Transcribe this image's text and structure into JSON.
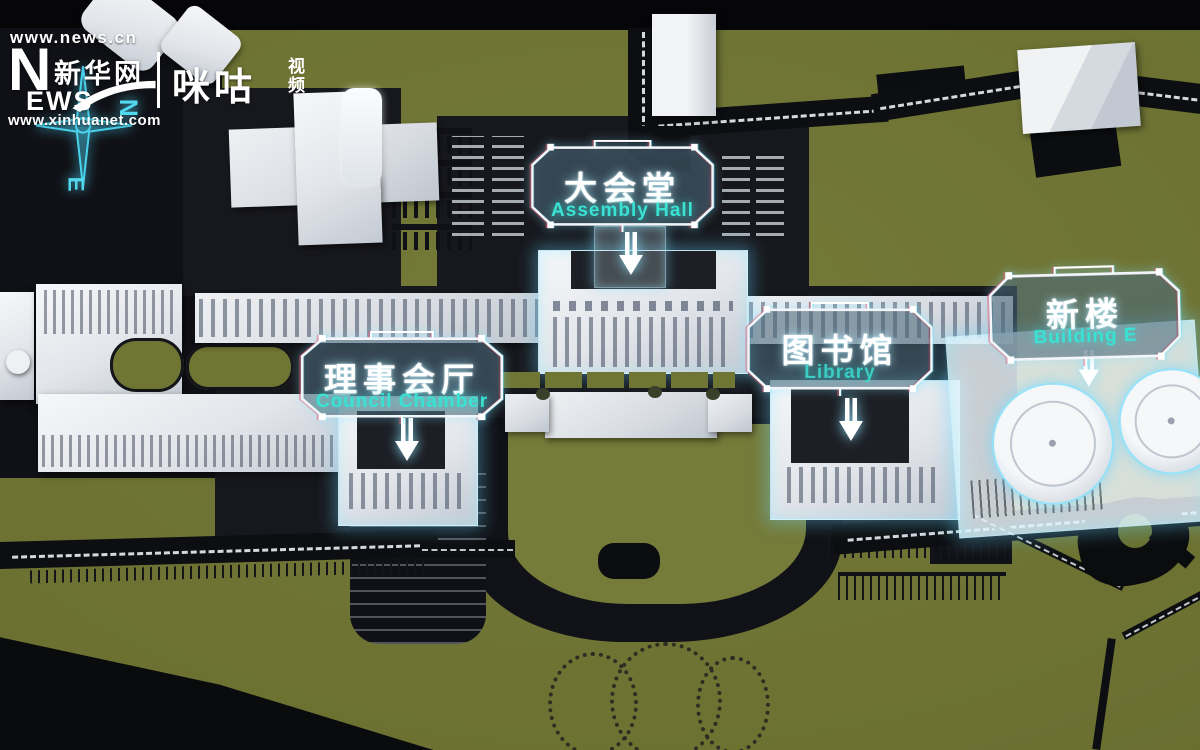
{
  "branding": {
    "news_url": "www.news.cn",
    "logo": {
      "n": "N",
      "ews": "EWS",
      "zh": "新华网",
      "site_url": "www.xinhuanet.com"
    },
    "partner": {
      "name_zh": "咪咕",
      "suffix_top": "视",
      "suffix_bottom": "频"
    }
  },
  "compass": {
    "north": "N",
    "east": "E"
  },
  "labels": [
    {
      "id": "assembly-hall",
      "zh": "大会堂",
      "en": "Assembly Hall"
    },
    {
      "id": "council-chamber",
      "zh": "理事会厅",
      "en": "Council Chamber"
    },
    {
      "id": "library",
      "zh": "图书馆",
      "en": "Library"
    },
    {
      "id": "building-e",
      "zh": "新楼",
      "en": "Building E"
    }
  ],
  "colors": {
    "grass": "#6c7132",
    "road": "#0d0e11",
    "plaza": "#17181d",
    "building_white": "#e9ebee",
    "hud_white": "#f2f6fa",
    "hud_cyan": "#3ae2d4",
    "glow_cyan": "#7fdfff",
    "compass_cyan": "#4ad2ec"
  }
}
